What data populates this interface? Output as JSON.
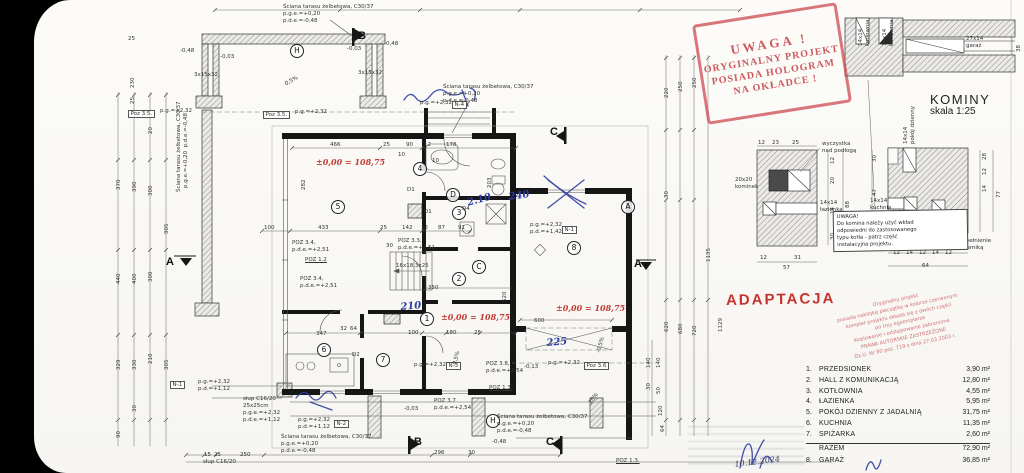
{
  "colors": {
    "stamp_red": "#c9474d",
    "adapt_red": "#c5332e",
    "hand_red": "#c23b33",
    "hand_blue": "#2c3da0",
    "ink": "#222222",
    "paper": "#fbfaf7"
  },
  "stamps": {
    "hologram": {
      "lines": [
        "UWAGA !",
        "ORYGINALNY PROJEKT",
        "POSIADA HOLOGRAM",
        "NA OKŁADCE !"
      ]
    },
    "adaptacja": "ADAPTACJA",
    "copyright": {
      "lines": [
        "Oryginalny projekt",
        "posiada naklejkę pieczątkę w kolorze czerwonym",
        "komplet projektu składa się z dwóch części",
        "po trzy egzemplarze",
        "Kopiowanie i odstępowanie zabronione",
        "PRAWA AUTORSKIE ZASTRZEŻONE",
        "Dz.U. Nr 80 poz. 719 z dnia 27.03.2003 r."
      ]
    },
    "chimney_note": {
      "lines": [
        "UWAGA!",
        "Do komina należy użyć wkład",
        "odpowiedni do zastosowanego",
        "typu kotła - patrz część",
        "instalacyjna projektu."
      ]
    },
    "handwritten_date": "10.12.2024"
  },
  "kominy": {
    "title": "KOMINY",
    "scale": "skala 1:25"
  },
  "schedule": {
    "rows": [
      {
        "no": "1.",
        "name": "PRZEDSIONEK",
        "area": "3,90",
        "unit": "m²"
      },
      {
        "no": "2.",
        "name": "HALL Z KOMUNIKACJĄ",
        "area": "12,80",
        "unit": "m²"
      },
      {
        "no": "3.",
        "name": "KOTŁOWNIA",
        "area": "4,55",
        "unit": "m²"
      },
      {
        "no": "4.",
        "name": "ŁAZIENKA",
        "area": "5,95",
        "unit": "m²"
      },
      {
        "no": "5.",
        "name": "POKÓJ DZIENNY Z JADALNIĄ",
        "area": "31,75",
        "unit": "m²"
      },
      {
        "no": "6.",
        "name": "KUCHNIA",
        "area": "11,35",
        "unit": "m²"
      },
      {
        "no": "7.",
        "name": "SPIŻARKA",
        "area": "2,60",
        "unit": "m²"
      }
    ],
    "total_label": "RAZEM",
    "total_area": "72,90",
    "extra_rows": [
      {
        "no": "8.",
        "name": "GARAŻ",
        "area": "36,85",
        "unit": "m²"
      }
    ],
    "unit": "m²"
  },
  "labels": [
    {
      "t": "B",
      "x": 358,
      "y": 30,
      "c": "sec",
      "n": "section-marker-B-top"
    },
    {
      "t": "C",
      "x": 550,
      "y": 126,
      "c": "sec",
      "n": "section-marker-C-top"
    },
    {
      "t": "A",
      "x": 166,
      "y": 256,
      "c": "sec",
      "n": "section-marker-A-left"
    },
    {
      "t": "A",
      "x": 634,
      "y": 258,
      "c": "sec",
      "n": "section-marker-A-right"
    },
    {
      "t": "B",
      "x": 414,
      "y": 436,
      "c": "sec",
      "n": "section-marker-B-bottom"
    },
    {
      "t": "C",
      "x": 546,
      "y": 436,
      "c": "sec",
      "n": "section-marker-C-bottom"
    },
    {
      "t": "H",
      "x": 290,
      "y": 44,
      "c": "circ",
      "n": "axis-marker-H"
    },
    {
      "t": "H",
      "x": 486,
      "y": 414,
      "c": "circ",
      "n": "axis-marker-H2"
    },
    {
      "t": "A",
      "x": 621,
      "y": 200,
      "c": "circ",
      "n": "axis-marker-A"
    },
    {
      "t": "C",
      "x": 472,
      "y": 260,
      "c": "circ",
      "n": "axis-marker-C"
    },
    {
      "t": "D",
      "x": 446,
      "y": 188,
      "c": "circ",
      "n": "axis-marker-D"
    },
    {
      "t": "1",
      "x": 420,
      "y": 312,
      "c": "circ",
      "n": "room-1-przedsionek"
    },
    {
      "t": "2",
      "x": 452,
      "y": 272,
      "c": "circ",
      "n": "room-2-hall"
    },
    {
      "t": "3",
      "x": 452,
      "y": 206,
      "c": "circ",
      "n": "room-3-kotlownia"
    },
    {
      "t": "4",
      "x": 413,
      "y": 162,
      "c": "circ",
      "n": "room-4-lazienka"
    },
    {
      "t": "5",
      "x": 331,
      "y": 200,
      "c": "circ",
      "n": "room-5-pokoj-dzienny"
    },
    {
      "t": "6",
      "x": 317,
      "y": 343,
      "c": "circ",
      "n": "room-6-kuchnia"
    },
    {
      "t": "7",
      "x": 376,
      "y": 353,
      "c": "circ",
      "n": "room-7-spizarka"
    },
    {
      "t": "8",
      "x": 567,
      "y": 241,
      "c": "circ",
      "n": "room-8-garaz"
    },
    {
      "t": "Ściana tarasu żelbetowa, C30/37",
      "x": 283,
      "y": 4
    },
    {
      "t": "p.g.e.=+0,20",
      "x": 283,
      "y": 11
    },
    {
      "t": "p.d.e.=-0,48",
      "x": 283,
      "y": 18
    },
    {
      "t": "Ściana tarasu żelbetowa, C30/37",
      "x": 443,
      "y": 84
    },
    {
      "t": "p.g.e.=+0,20",
      "x": 443,
      "y": 91
    },
    {
      "t": "p.d.e.=-0,48",
      "x": 443,
      "y": 98
    },
    {
      "t": "Ściana tarasu żelbetowa, C30/37",
      "x": 176,
      "y": 192,
      "r": -90
    },
    {
      "t": "p.g.e.=+0,20  p.d.e.=-0,48",
      "x": 183,
      "y": 188,
      "r": -90
    },
    {
      "t": "Ściana tarasu żelbetowa, C30/37",
      "x": 281,
      "y": 434
    },
    {
      "t": "p.g.e.=+0,20",
      "x": 281,
      "y": 441
    },
    {
      "t": "p.d.e.=-0,48",
      "x": 281,
      "y": 448
    },
    {
      "t": "Ściana tarasu żelbetowa, C30/37",
      "x": 497,
      "y": 414
    },
    {
      "t": "p.g.e.=+0,20",
      "x": 497,
      "y": 421
    },
    {
      "t": "p.d.e.=-0,48",
      "x": 497,
      "y": 428
    },
    {
      "t": "Poz 3.5.",
      "x": 128,
      "y": 110,
      "c": "box"
    },
    {
      "t": "p.g.=+2,32",
      "x": 160,
      "y": 108
    },
    {
      "t": "Poz 3.5.",
      "x": 263,
      "y": 111,
      "c": "box"
    },
    {
      "t": "p.g.=+2,32",
      "x": 295,
      "y": 109
    },
    {
      "t": "POZ 3.4,",
      "x": 292,
      "y": 240
    },
    {
      "t": "p.d.e.=+2,51",
      "x": 292,
      "y": 247
    },
    {
      "t": "POZ 1.2",
      "x": 305,
      "y": 257,
      "c": "und"
    },
    {
      "t": "POZ 3.3,",
      "x": 398,
      "y": 238
    },
    {
      "t": "p.d.e.=+2,51",
      "x": 398,
      "y": 245
    },
    {
      "t": "POZ 3.4,",
      "x": 300,
      "y": 276
    },
    {
      "t": "p.d.e.=+2,51",
      "x": 300,
      "y": 283
    },
    {
      "t": "16x18,3x25",
      "x": 396,
      "y": 263
    },
    {
      "t": "POZ 3.7",
      "x": 434,
      "y": 398
    },
    {
      "t": "p.d.e.=+2,54",
      "x": 434,
      "y": 405
    },
    {
      "t": "POZ 3.8,",
      "x": 486,
      "y": 361
    },
    {
      "t": "p.d.e.=+2,54",
      "x": 486,
      "y": 368
    },
    {
      "t": "p.g.=+2,32",
      "x": 548,
      "y": 360
    },
    {
      "t": "Poz 3.6",
      "x": 584,
      "y": 362,
      "c": "box"
    },
    {
      "t": "POZ 1.3.",
      "x": 489,
      "y": 385,
      "c": "und"
    },
    {
      "t": "POZ 1.3.",
      "x": 616,
      "y": 458,
      "c": "und"
    },
    {
      "t": "p.g.=+2,32",
      "x": 420,
      "y": 100
    },
    {
      "t": "N-4",
      "x": 452,
      "y": 101,
      "c": "box"
    },
    {
      "t": "p.g.=+2,32",
      "x": 530,
      "y": 222
    },
    {
      "t": "p.d.=+1,42",
      "x": 530,
      "y": 229
    },
    {
      "t": "N-1",
      "x": 562,
      "y": 226,
      "c": "box"
    },
    {
      "t": "p.g.=+2,32",
      "x": 414,
      "y": 362
    },
    {
      "t": "N-3",
      "x": 446,
      "y": 362,
      "c": "box"
    },
    {
      "t": "p.g.=+2,32",
      "x": 298,
      "y": 417
    },
    {
      "t": "p.d.=+1,12",
      "x": 298,
      "y": 424
    },
    {
      "t": "N-2",
      "x": 334,
      "y": 420,
      "c": "box"
    },
    {
      "t": "N-1",
      "x": 170,
      "y": 381,
      "c": "box"
    },
    {
      "t": "p.g.=+2,32",
      "x": 198,
      "y": 379
    },
    {
      "t": "p.d.=+1,12",
      "x": 198,
      "y": 386
    },
    {
      "t": "słup C16/20",
      "x": 243,
      "y": 396
    },
    {
      "t": "25x25cm",
      "x": 243,
      "y": 403
    },
    {
      "t": "p.g.e.=+2,32",
      "x": 243,
      "y": 410
    },
    {
      "t": "p.d.e.=+1,12",
      "x": 243,
      "y": 417
    },
    {
      "t": "słup C16/20",
      "x": 203,
      "y": 459
    },
    {
      "t": "-0,48",
      "x": 180,
      "y": 48,
      "c": "lvl"
    },
    {
      "t": "-0,03",
      "x": 220,
      "y": 54,
      "c": "lvl"
    },
    {
      "t": "-0,03",
      "x": 347,
      "y": 46,
      "c": "lvl"
    },
    {
      "t": "-0,48",
      "x": 384,
      "y": 41,
      "c": "lvl"
    },
    {
      "t": "-0,03",
      "x": 404,
      "y": 406,
      "c": "lvl"
    },
    {
      "t": "-0,48",
      "x": 492,
      "y": 439,
      "c": "lvl"
    },
    {
      "t": "-0,13",
      "x": 524,
      "y": 364,
      "c": "lvl"
    },
    {
      "t": "0,5%",
      "x": 284,
      "y": 82,
      "r": -30
    },
    {
      "t": "0,5%",
      "x": 452,
      "y": 364,
      "r": -75
    },
    {
      "t": "-0,5%",
      "x": 596,
      "y": 352,
      "r": -75
    },
    {
      "t": "20%",
      "x": 588,
      "y": 402,
      "r": -55
    },
    {
      "t": "±0,00 = 108,75",
      "x": 316,
      "y": 157,
      "c": "redh",
      "n": "red-level-annotation"
    },
    {
      "t": "±0,00 = 108,75",
      "x": 441,
      "y": 312,
      "c": "redh",
      "n": "red-level-annotation"
    },
    {
      "t": "±0,00 = 108,75",
      "x": 556,
      "y": 303,
      "c": "redh",
      "n": "red-level-annotation"
    },
    {
      "t": "240",
      "x": 508,
      "y": 192,
      "c": "blueh",
      "r": -8,
      "n": "blue-handwriting"
    },
    {
      "t": "210",
      "x": 400,
      "y": 302,
      "c": "blueh",
      "r": -5,
      "n": "blue-handwriting"
    },
    {
      "t": "2.10",
      "x": 466,
      "y": 198,
      "c": "blueh",
      "r": -15,
      "n": "blue-handwriting"
    },
    {
      "t": "225",
      "x": 546,
      "y": 338,
      "c": "blueh",
      "r": -5,
      "n": "blue-handwriting"
    },
    {
      "t": "D1",
      "x": 407,
      "y": 187
    },
    {
      "t": "D1",
      "x": 424,
      "y": 209
    },
    {
      "t": "D2",
      "x": 352,
      "y": 352
    },
    {
      "t": "D4",
      "x": 462,
      "y": 206
    },
    {
      "t": "466",
      "x": 330,
      "y": 142
    },
    {
      "t": "25",
      "x": 383,
      "y": 142
    },
    {
      "t": "90",
      "x": 406,
      "y": 142
    },
    {
      "t": "12",
      "x": 424,
      "y": 142
    },
    {
      "t": "178",
      "x": 446,
      "y": 142
    },
    {
      "t": "10",
      "x": 398,
      "y": 152
    },
    {
      "t": "10",
      "x": 432,
      "y": 158
    },
    {
      "t": "100",
      "x": 264,
      "y": 225
    },
    {
      "t": "433",
      "x": 318,
      "y": 225
    },
    {
      "t": "25",
      "x": 380,
      "y": 225
    },
    {
      "t": "142",
      "x": 402,
      "y": 225
    },
    {
      "t": "12",
      "x": 421,
      "y": 225
    },
    {
      "t": "87",
      "x": 438,
      "y": 225
    },
    {
      "t": "91",
      "x": 458,
      "y": 225
    },
    {
      "t": "350",
      "x": 428,
      "y": 285
    },
    {
      "t": "30",
      "x": 386,
      "y": 243
    },
    {
      "t": "100",
      "x": 408,
      "y": 330
    },
    {
      "t": "180",
      "x": 446,
      "y": 330
    },
    {
      "t": "25",
      "x": 474,
      "y": 330
    },
    {
      "t": "347",
      "x": 316,
      "y": 331
    },
    {
      "t": "32",
      "x": 340,
      "y": 326
    },
    {
      "t": "64",
      "x": 350,
      "y": 326
    },
    {
      "t": "600",
      "x": 534,
      "y": 318
    },
    {
      "t": "520",
      "x": 502,
      "y": 302,
      "r": -90
    },
    {
      "t": "282",
      "x": 301,
      "y": 190,
      "r": -90
    },
    {
      "t": "203",
      "x": 487,
      "y": 188,
      "r": -90
    },
    {
      "t": "25",
      "x": 128,
      "y": 36
    },
    {
      "t": "230",
      "x": 130,
      "y": 88,
      "r": -90
    },
    {
      "t": "25",
      "x": 130,
      "y": 104,
      "r": -90
    },
    {
      "t": "3x15x32",
      "x": 194,
      "y": 72
    },
    {
      "t": "3x15x32",
      "x": 358,
      "y": 70
    },
    {
      "t": "370",
      "x": 116,
      "y": 190,
      "r": -90
    },
    {
      "t": "440",
      "x": 116,
      "y": 284,
      "r": -90
    },
    {
      "t": "329",
      "x": 116,
      "y": 370,
      "r": -90
    },
    {
      "t": "90",
      "x": 116,
      "y": 438,
      "r": -90
    },
    {
      "t": "390",
      "x": 132,
      "y": 192,
      "r": -90
    },
    {
      "t": "400",
      "x": 132,
      "y": 284,
      "r": -90
    },
    {
      "t": "330",
      "x": 132,
      "y": 370,
      "r": -90
    },
    {
      "t": "30",
      "x": 132,
      "y": 412,
      "r": -90
    },
    {
      "t": "300",
      "x": 148,
      "y": 196,
      "r": -90
    },
    {
      "t": "300",
      "x": 148,
      "y": 282,
      "r": -90
    },
    {
      "t": "210",
      "x": 148,
      "y": 364,
      "r": -90
    },
    {
      "t": "20",
      "x": 148,
      "y": 134,
      "r": -90
    },
    {
      "t": "905",
      "x": 164,
      "y": 234,
      "r": -90
    },
    {
      "t": "305",
      "x": 164,
      "y": 370,
      "r": -90
    },
    {
      "t": "220",
      "x": 664,
      "y": 98,
      "r": -90
    },
    {
      "t": "30",
      "x": 664,
      "y": 198,
      "r": -90
    },
    {
      "t": "620",
      "x": 664,
      "y": 332,
      "r": -90
    },
    {
      "t": "250",
      "x": 678,
      "y": 92,
      "r": -90
    },
    {
      "t": "680",
      "x": 678,
      "y": 334,
      "r": -90
    },
    {
      "t": "250",
      "x": 692,
      "y": 88,
      "r": -90
    },
    {
      "t": "720",
      "x": 692,
      "y": 336,
      "r": -90
    },
    {
      "t": "1135",
      "x": 706,
      "y": 262,
      "r": -90
    },
    {
      "t": "1129",
      "x": 718,
      "y": 332,
      "r": -90
    },
    {
      "t": "140",
      "x": 646,
      "y": 368,
      "r": -90
    },
    {
      "t": "30",
      "x": 646,
      "y": 390,
      "r": -90
    },
    {
      "t": "140",
      "x": 656,
      "y": 368,
      "r": -90
    },
    {
      "t": "50",
      "x": 656,
      "y": 394,
      "r": -90
    },
    {
      "t": "120",
      "x": 658,
      "y": 416,
      "r": -90
    },
    {
      "t": "64",
      "x": 660,
      "y": 432,
      "r": -90
    },
    {
      "t": "15",
      "x": 204,
      "y": 452
    },
    {
      "t": "25",
      "x": 214,
      "y": 452
    },
    {
      "t": "250",
      "x": 240,
      "y": 452
    },
    {
      "t": "296",
      "x": 434,
      "y": 450
    },
    {
      "t": "30",
      "x": 468,
      "y": 450
    },
    {
      "t": "14x14",
      "x": 858,
      "y": 46,
      "r": -90,
      "n": "chimney-label"
    },
    {
      "t": "kotłownia",
      "x": 865,
      "y": 46,
      "r": -90,
      "n": "chimney-label"
    },
    {
      "t": "14x14",
      "x": 882,
      "y": 46,
      "r": -90,
      "n": "chimney-label"
    },
    {
      "t": "kotłownia",
      "x": 889,
      "y": 46,
      "r": -90,
      "n": "chimney-label"
    },
    {
      "t": "27x14",
      "x": 966,
      "y": 36,
      "n": "chimney-label"
    },
    {
      "t": "garaż",
      "x": 966,
      "y": 43,
      "n": "chimney-label"
    },
    {
      "t": "38",
      "x": 1016,
      "y": 52,
      "r": -90
    },
    {
      "t": "wyczystka",
      "x": 822,
      "y": 141
    },
    {
      "t": "nad podłogą",
      "x": 822,
      "y": 148
    },
    {
      "t": "20x20",
      "x": 735,
      "y": 177,
      "n": "chimney-label"
    },
    {
      "t": "kominek",
      "x": 735,
      "y": 184,
      "n": "chimney-label"
    },
    {
      "t": "14x14",
      "x": 820,
      "y": 200,
      "n": "chimney-label"
    },
    {
      "t": "łazienka",
      "x": 820,
      "y": 207,
      "n": "chimney-label"
    },
    {
      "t": "12",
      "x": 758,
      "y": 140
    },
    {
      "t": "23",
      "x": 772,
      "y": 140
    },
    {
      "t": "25",
      "x": 792,
      "y": 140
    },
    {
      "t": "12",
      "x": 760,
      "y": 255
    },
    {
      "t": "31",
      "x": 794,
      "y": 255
    },
    {
      "t": "57",
      "x": 783,
      "y": 265
    },
    {
      "t": "88",
      "x": 845,
      "y": 208,
      "r": -90
    },
    {
      "t": "12",
      "x": 830,
      "y": 164,
      "r": -90
    },
    {
      "t": "20",
      "x": 830,
      "y": 184,
      "r": -90
    },
    {
      "t": "14",
      "x": 830,
      "y": 214,
      "r": -90
    },
    {
      "t": "30",
      "x": 830,
      "y": 240,
      "r": -90
    },
    {
      "t": "14x14",
      "x": 903,
      "y": 144,
      "r": -90,
      "n": "chimney-label"
    },
    {
      "t": "pokój dzienny",
      "x": 910,
      "y": 144,
      "r": -90,
      "n": "chimney-label"
    },
    {
      "t": "14x14",
      "x": 870,
      "y": 198,
      "n": "chimney-label"
    },
    {
      "t": "kuchnia",
      "x": 870,
      "y": 205,
      "n": "chimney-label"
    },
    {
      "t": "14x14",
      "x": 928,
      "y": 250,
      "r": -90,
      "n": "chimney-label"
    },
    {
      "t": "spiżarka",
      "x": 935,
      "y": 250,
      "r": -90,
      "n": "chimney-label"
    },
    {
      "t": "wypełnienie",
      "x": 958,
      "y": 238
    },
    {
      "t": "ceramiką",
      "x": 958,
      "y": 245
    },
    {
      "t": "12",
      "x": 893,
      "y": 250
    },
    {
      "t": "14",
      "x": 906,
      "y": 250
    },
    {
      "t": "12",
      "x": 919,
      "y": 250
    },
    {
      "t": "14",
      "x": 932,
      "y": 250
    },
    {
      "t": "12",
      "x": 945,
      "y": 250
    },
    {
      "t": "64",
      "x": 922,
      "y": 263
    },
    {
      "t": "77",
      "x": 996,
      "y": 198,
      "r": -90
    },
    {
      "t": "30",
      "x": 872,
      "y": 162,
      "r": -90
    },
    {
      "t": "47",
      "x": 872,
      "y": 196,
      "r": -90
    },
    {
      "t": "28",
      "x": 982,
      "y": 160,
      "r": -90
    },
    {
      "t": "12",
      "x": 982,
      "y": 175,
      "r": -90
    },
    {
      "t": "14",
      "x": 982,
      "y": 192,
      "r": -90
    },
    {
      "t": "KOMINY",
      "x": 930,
      "y": 92,
      "c": "big",
      "n": "kominy-title"
    },
    {
      "t": "skala 1:25",
      "x": 930,
      "y": 106,
      "c": "med",
      "n": "kominy-scale"
    },
    {
      "t": "10.12.2024",
      "x": 734,
      "y": 460,
      "c": "dateh",
      "r": -7,
      "n": "handwritten-date"
    }
  ]
}
